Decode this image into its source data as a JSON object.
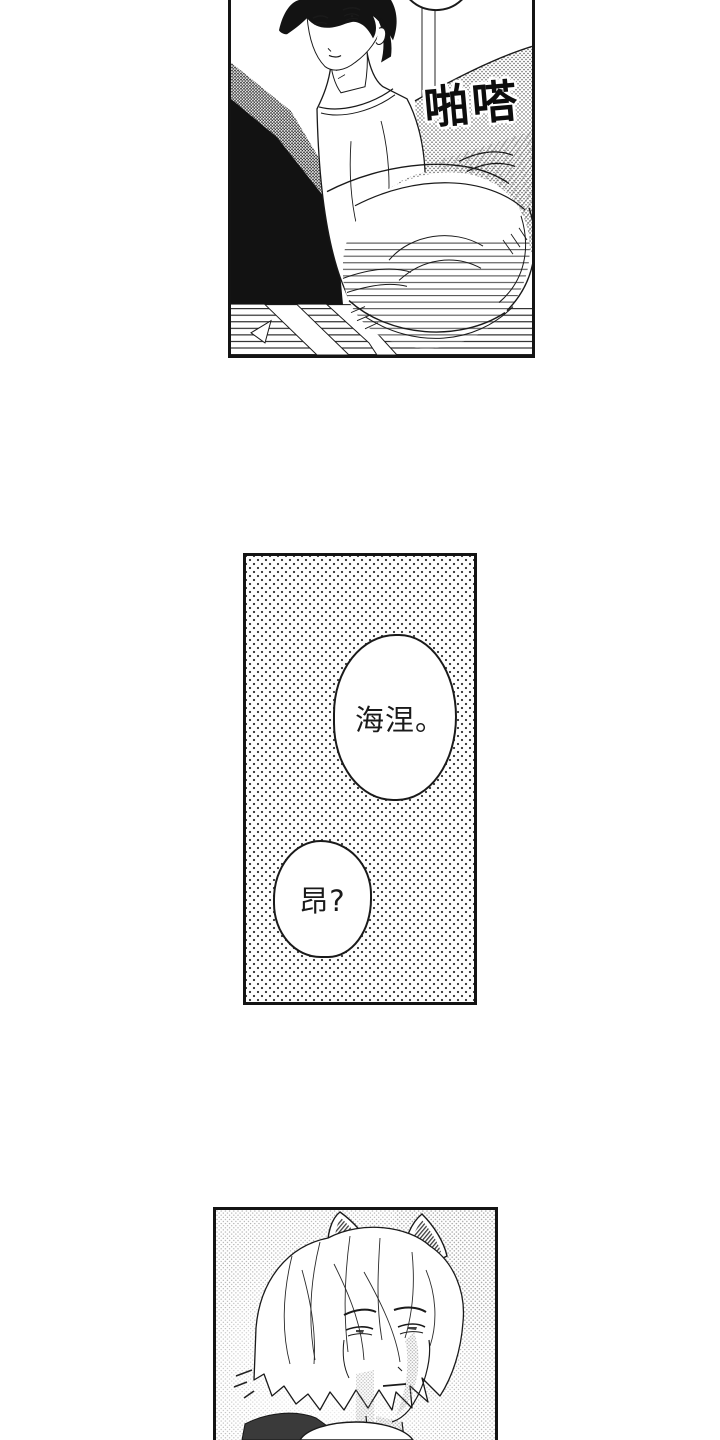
{
  "page": {
    "background": "#ffffff",
    "ink": "#141414"
  },
  "panels": [
    {
      "name": "top-panel",
      "alt": "Dark-haired young man in a white tee glances back while a fluffy tail swishes against a dotted sofa",
      "sfx": "啪嗒"
    },
    {
      "name": "middle-panel",
      "alt": "Polka-dot tone panel with two speech bubbles",
      "bubbles": [
        {
          "text": "海涅。"
        },
        {
          "text": "昂?"
        }
      ]
    },
    {
      "name": "bottom-panel",
      "alt": "White-haired man with furry animal ears looking unamused"
    }
  ]
}
